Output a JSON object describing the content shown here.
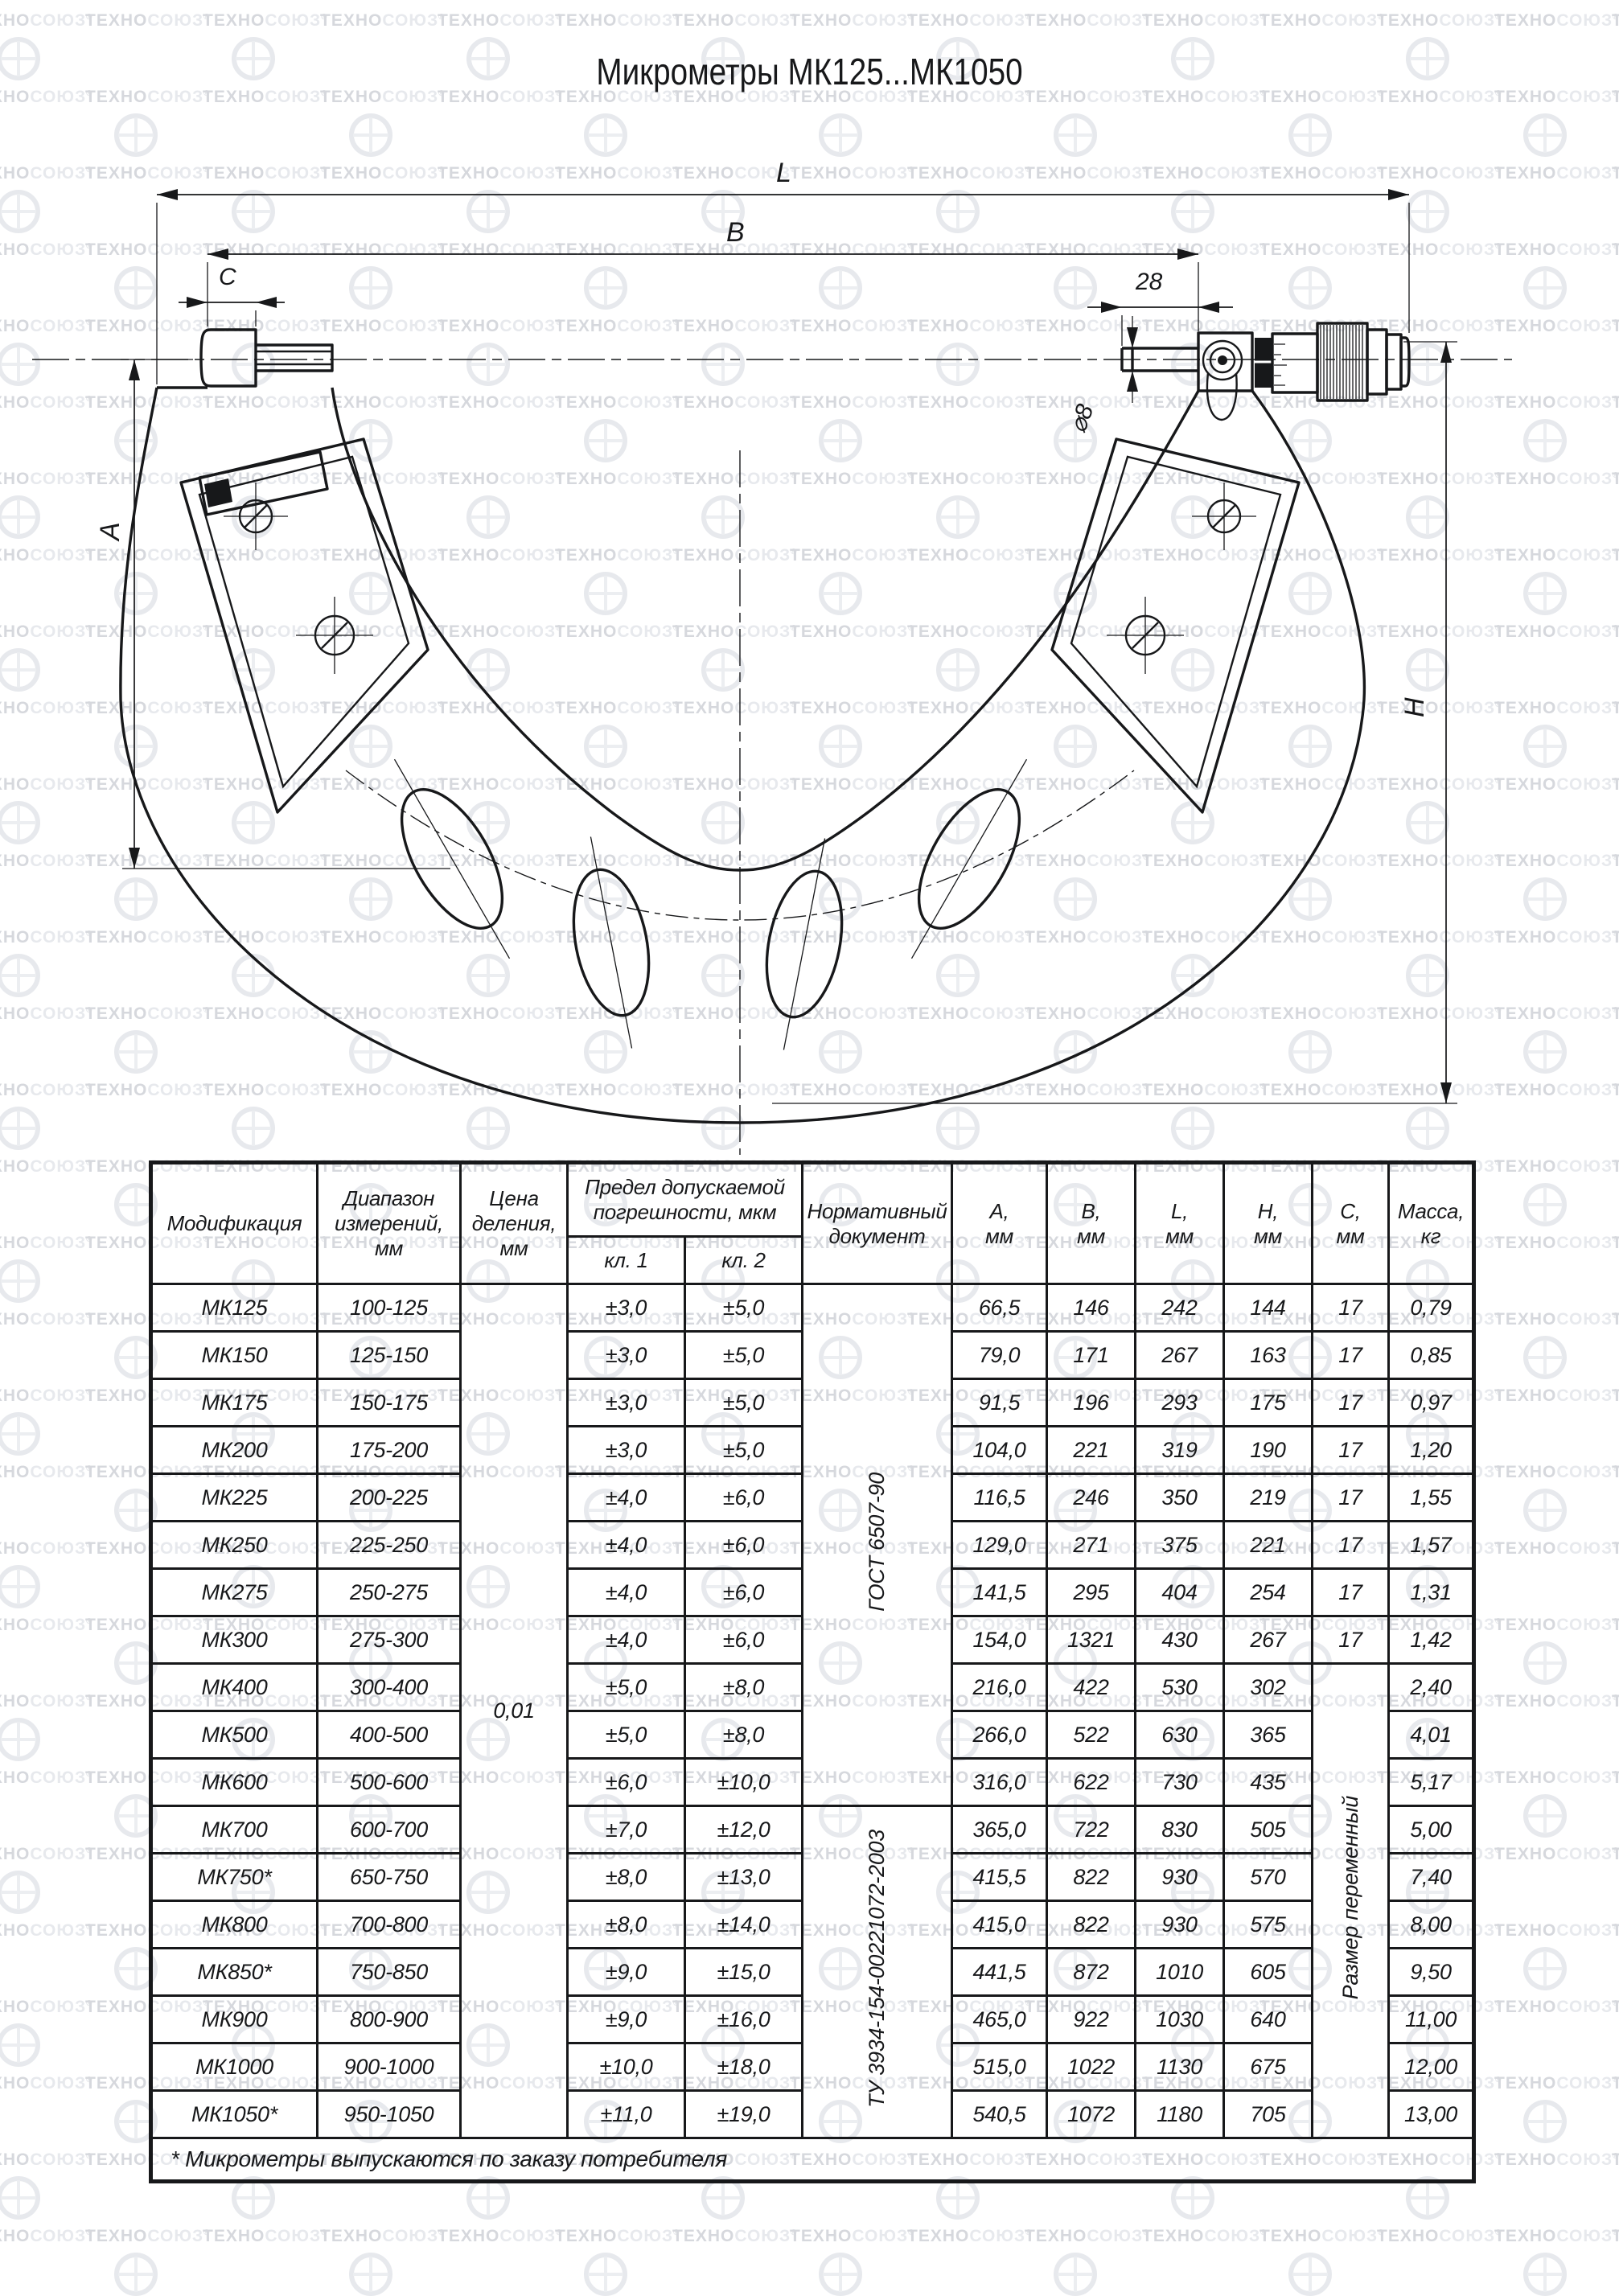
{
  "watermark": {
    "brand_left": "ТЕХНО",
    "brand_right": "СОЮЗ",
    "registered": "®"
  },
  "page": {
    "title": "Микрометры МК125...МК1050"
  },
  "drawing": {
    "labels": {
      "total_length": "L",
      "body_width": "B",
      "anvil_width": "C",
      "head_offset": "28",
      "spindle_diameter": "⌀8",
      "frame_depth": "A",
      "frame_height": "H"
    }
  },
  "table": {
    "headers": {
      "modification": "Модификация",
      "range": "Диапазон\nизмерений,\nмм",
      "division": "Цена\nделения,\nмм",
      "error_limit": "Предел допускаемой\nпогрешности, мкм",
      "kl1": "кл. 1",
      "kl2": "кл. 2",
      "document": "Нормативный\nдокумент",
      "a": "А,\nмм",
      "b": "В,\nмм",
      "l": "L,\nмм",
      "h": "Н,\nмм",
      "c": "С,\nмм",
      "mass": "Масса,\nкг"
    },
    "merged": {
      "division_value": "0,01",
      "doc1": "ГОСТ 6507-90",
      "doc1_rowspan": 11,
      "doc2": "ТУ 3934-154-00221072-2003",
      "doc2_rowspan": 7,
      "c_text": "Размер переменный",
      "c_start": 8,
      "c_rowspan": 10
    },
    "rows": [
      {
        "model": "МК125",
        "range": "100-125",
        "kl1": "±3,0",
        "kl2": "±5,0",
        "a": "66,5",
        "b": "146",
        "l": "242",
        "h": "144",
        "c": "17",
        "mass": "0,79"
      },
      {
        "model": "МК150",
        "range": "125-150",
        "kl1": "±3,0",
        "kl2": "±5,0",
        "a": "79,0",
        "b": "171",
        "l": "267",
        "h": "163",
        "c": "17",
        "mass": "0,85"
      },
      {
        "model": "МК175",
        "range": "150-175",
        "kl1": "±3,0",
        "kl2": "±5,0",
        "a": "91,5",
        "b": "196",
        "l": "293",
        "h": "175",
        "c": "17",
        "mass": "0,97"
      },
      {
        "model": "МК200",
        "range": "175-200",
        "kl1": "±3,0",
        "kl2": "±5,0",
        "a": "104,0",
        "b": "221",
        "l": "319",
        "h": "190",
        "c": "17",
        "mass": "1,20"
      },
      {
        "model": "МК225",
        "range": "200-225",
        "kl1": "±4,0",
        "kl2": "±6,0",
        "a": "116,5",
        "b": "246",
        "l": "350",
        "h": "219",
        "c": "17",
        "mass": "1,55"
      },
      {
        "model": "МК250",
        "range": "225-250",
        "kl1": "±4,0",
        "kl2": "±6,0",
        "a": "129,0",
        "b": "271",
        "l": "375",
        "h": "221",
        "c": "17",
        "mass": "1,57"
      },
      {
        "model": "МК275",
        "range": "250-275",
        "kl1": "±4,0",
        "kl2": "±6,0",
        "a": "141,5",
        "b": "295",
        "l": "404",
        "h": "254",
        "c": "17",
        "mass": "1,31"
      },
      {
        "model": "МК300",
        "range": "275-300",
        "kl1": "±4,0",
        "kl2": "±6,0",
        "a": "154,0",
        "b": "1321",
        "l": "430",
        "h": "267",
        "c": "17",
        "mass": "1,42"
      },
      {
        "model": "МК400",
        "range": "300-400",
        "kl1": "±5,0",
        "kl2": "±8,0",
        "a": "216,0",
        "b": "422",
        "l": "530",
        "h": "302",
        "c": null,
        "mass": "2,40"
      },
      {
        "model": "МК500",
        "range": "400-500",
        "kl1": "±5,0",
        "kl2": "±8,0",
        "a": "266,0",
        "b": "522",
        "l": "630",
        "h": "365",
        "c": null,
        "mass": "4,01"
      },
      {
        "model": "МК600",
        "range": "500-600",
        "kl1": "±6,0",
        "kl2": "±10,0",
        "a": "316,0",
        "b": "622",
        "l": "730",
        "h": "435",
        "c": null,
        "mass": "5,17"
      },
      {
        "model": "МК700",
        "range": "600-700",
        "kl1": "±7,0",
        "kl2": "±12,0",
        "a": "365,0",
        "b": "722",
        "l": "830",
        "h": "505",
        "c": null,
        "mass": "5,00"
      },
      {
        "model": "МК750*",
        "range": "650-750",
        "kl1": "±8,0",
        "kl2": "±13,0",
        "a": "415,5",
        "b": "822",
        "l": "930",
        "h": "570",
        "c": null,
        "mass": "7,40"
      },
      {
        "model": "МК800",
        "range": "700-800",
        "kl1": "±8,0",
        "kl2": "±14,0",
        "a": "415,0",
        "b": "822",
        "l": "930",
        "h": "575",
        "c": null,
        "mass": "8,00"
      },
      {
        "model": "МК850*",
        "range": "750-850",
        "kl1": "±9,0",
        "kl2": "±15,0",
        "a": "441,5",
        "b": "872",
        "l": "1010",
        "h": "605",
        "c": null,
        "mass": "9,50"
      },
      {
        "model": "МК900",
        "range": "800-900",
        "kl1": "±9,0",
        "kl2": "±16,0",
        "a": "465,0",
        "b": "922",
        "l": "1030",
        "h": "640",
        "c": null,
        "mass": "11,00"
      },
      {
        "model": "МК1000",
        "range": "900-1000",
        "kl1": "±10,0",
        "kl2": "±18,0",
        "a": "515,0",
        "b": "1022",
        "l": "1130",
        "h": "675",
        "c": null,
        "mass": "12,00"
      },
      {
        "model": "МК1050*",
        "range": "950-1050",
        "kl1": "±11,0",
        "kl2": "±19,0",
        "a": "540,5",
        "b": "1072",
        "l": "1180",
        "h": "705",
        "c": null,
        "mass": "13,00"
      }
    ],
    "footnote": "* Микрометры выпускаются по заказу потребителя"
  }
}
